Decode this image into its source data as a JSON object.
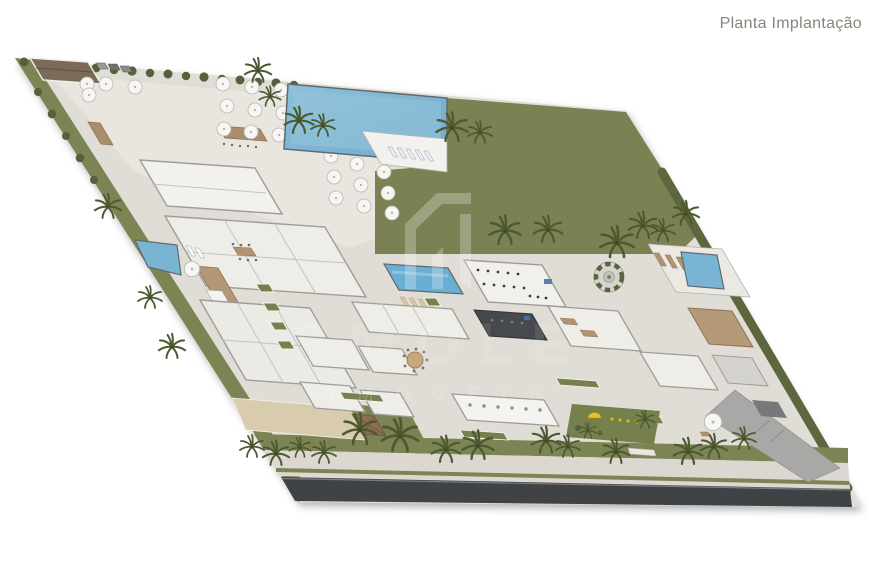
{
  "page": {
    "title": "Planta Implantação",
    "background": "#ffffff"
  },
  "watermark": {
    "word": "SMOLE",
    "subtitle": "IMÓVEIS",
    "logo": "angular-monogram-icon"
  },
  "palette": {
    "title_text": "#85857a",
    "lawn_green": "#7b8152",
    "verge_green": "#7d8454",
    "hedge_green": "#55613a",
    "palm_green": "#4d5a31",
    "pool_blue": "#79b4d2",
    "lap_pool_blue": "#6aaed3",
    "pool_rim": "#5d6a70",
    "paving": "#e0ddd6",
    "terrace": "#e9e6df",
    "building_white": "#f2f1ed",
    "building_stroke": "#9e9d99",
    "dark_roof": "#46494d",
    "wood_tan": "#b3936f",
    "deck_brown": "#b39878",
    "sand_court": "#d8cbae",
    "asphalt": "#404345",
    "sidewalk": "#dcd8d1",
    "driveway_gray": "#a8a8a6",
    "playground_yellow": "#e9c21c"
  },
  "plan": {
    "features": [
      "entrance-building",
      "restaurant-terrace",
      "umbrella-tables",
      "bar-counters",
      "parked-cars",
      "perimeter-hedge",
      "main-pool",
      "pool-deck",
      "sun-loungers",
      "lawn-field",
      "field-palms",
      "spa-building",
      "guest-rooms-building",
      "wood-deck-walkway",
      "left-pool",
      "sand-court",
      "machine-house",
      "lap-pool",
      "gym-building",
      "dark-studio",
      "clubhouse-rooms",
      "colonnade",
      "round-dining-table",
      "planters",
      "mandala-garden",
      "right-pool",
      "right-pool-deck",
      "service-driveway",
      "playground",
      "street-verge",
      "street-palms",
      "sidewalk",
      "asphalt-road"
    ]
  }
}
